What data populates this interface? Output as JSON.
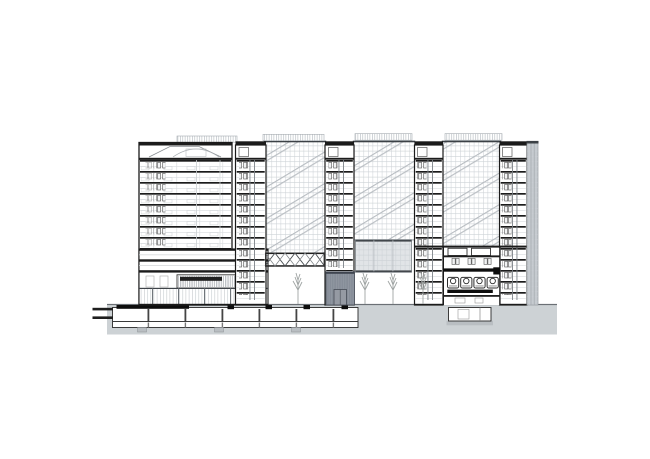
{
  "colors": {
    "background": "#ffffff",
    "ink": "#1b1b1b",
    "solid_black": "#0d0d0d",
    "line_medium": "#4a4f53",
    "line_light": "#9aa0a5",
    "glass_grid": "#ccd1d5",
    "escalator_band": "#b7bcc1",
    "ground": "#cdd2d5",
    "earth_footing": "#b9bec2",
    "dark_volume": "#868d98",
    "dark_volume_door": "#959aa3",
    "bridge_block": "#e1e4e7",
    "side_band": "#c5cacf",
    "screen_hatch": "#b3b9be",
    "tree": "#9fa4a3"
  },
  "structure": {
    "drawing_type_note": "",
    "left_tower_floor_slabs": 9,
    "service_cores": 4,
    "glazed_atrium_bays": 3,
    "rooftop_screens": 4,
    "basement_boxes": 2,
    "auditorium_seats": 4,
    "trees": 4,
    "track_lines_left": 2
  }
}
